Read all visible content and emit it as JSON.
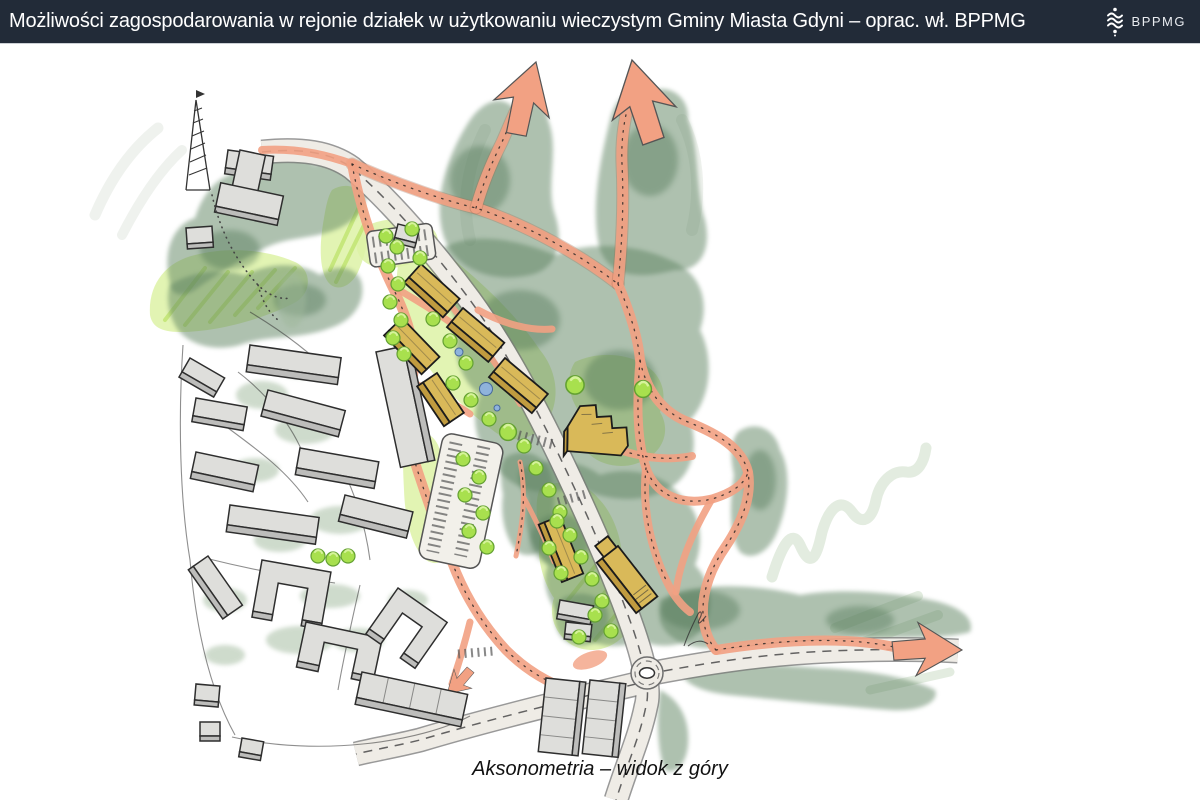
{
  "header": {
    "title": "Możliwości zagospodarowania w rejonie działek w użytkowaniu wieczystym Gminy Miasta Gdyni – oprac. wł. BPPMG",
    "logo_label": "BPPMG",
    "logo_icon": "wave-stack-icon"
  },
  "caption": "Aksonometria – widok z góry",
  "illustration": {
    "type": "hand-drawn axonometric site plan",
    "features": [
      "forest-watercolor-areas",
      "pedestrian-routes-salmon",
      "flow-arrows",
      "main-road-with-roundabout",
      "proposed-buildings-yellow",
      "existing-buildings-gray",
      "parking-areas",
      "trees",
      "ponds",
      "lattice-tower"
    ]
  },
  "colors": {
    "header_bg": "#222B38",
    "path_salmon": "#F2A183",
    "forest_green": "#5F8462",
    "tree_green": "#A8E04E",
    "lawn_green": "#DDF2A6",
    "proposed_building": "#D9B959",
    "existing_building": "#DEDEDB",
    "pond_blue": "#8FB3DC",
    "road_fill": "#EFECE6"
  }
}
